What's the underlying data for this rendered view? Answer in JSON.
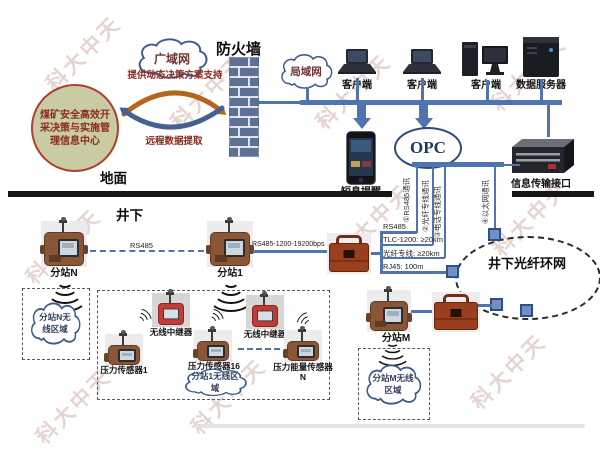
{
  "watermark": {
    "text": "科大中天"
  },
  "colors": {
    "line_blue": "#4f74ae",
    "brick_blue": "#5f7096",
    "circle_fill": "#c9cba3",
    "circle_border": "#b23b2e",
    "dark_red_text": "#8b2a20",
    "arrow_orange": "#b5651d",
    "arrow_blue": "#44618f",
    "repeater_red": "#c23b36",
    "device_brown": "#8a5638",
    "node_blue": "#7290c2"
  },
  "surface": {
    "zone_label": "地面",
    "info_center": "煤矿安全高效开采决策与实施管理信息中心",
    "wan_cloud": "广域网",
    "firewall": "防火墙",
    "support_arrow": "提供动态决策方案支持",
    "extract_arrow": "远程数据提取",
    "lan_cloud": "局域网",
    "client1": "客户端",
    "client2": "客户端",
    "client3": "客户端",
    "data_server": "数据服务器",
    "sms_alert": "短息提醒",
    "opc": "OPC",
    "info_interface": "信息传输接口"
  },
  "underground": {
    "zone_label": "井下",
    "comm1": "①RS485通讯",
    "comm2": "②光纤专线通讯",
    "comm3": "③电话专线通讯",
    "comm4": "④以太网通讯",
    "spec_rs485": "RS485",
    "spec_tlc": "TLC-1200: ≥20km",
    "spec_fiber": "光纤专线: ≥20km",
    "spec_rj45": "RJ45: 100m",
    "bus_rs485": "RS485",
    "bus_rs485_full": "RS485-1200-19200bps",
    "substation_n": "分站N",
    "substation_1": "分站1",
    "substation_m": "分站M",
    "ring": "井下光纤环网",
    "zone_n": "分站N无线区域",
    "zone_1": "分站1无线区域",
    "zone_m": "分站M无线区域",
    "repeater1": "无线中继器",
    "repeater2": "无线中继器",
    "sensor1": "压力传感器1",
    "sensor16": "压力传感器16",
    "sensorN": "压力能量传感器N"
  }
}
